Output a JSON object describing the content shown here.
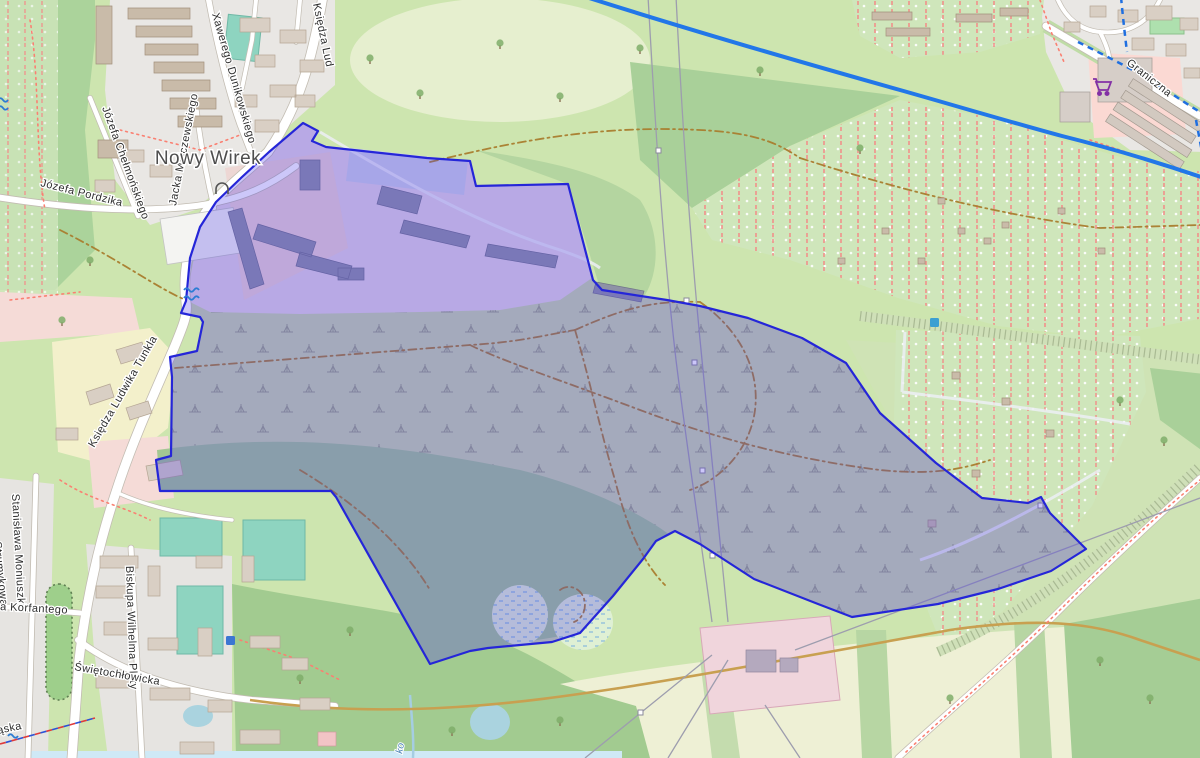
{
  "map": {
    "labels": {
      "place": [
        {
          "text": "Nowy Wirek"
        }
      ],
      "streets": [
        {
          "text": "Xawerego Dunikowskiego"
        },
        {
          "text": "Jacka Malczewskiego"
        },
        {
          "text": "Józefa Chełmońskiego"
        },
        {
          "text": "Księdza Lud"
        },
        {
          "text": "Józefa Pordzika"
        },
        {
          "text": "Księdza Ludwika Tunkla"
        },
        {
          "text": "Stanisława Moniuszki"
        },
        {
          "text": "Strumykowa"
        },
        {
          "text": "a Korfantego"
        },
        {
          "text": "Biskupa Wilhelma Pluty"
        },
        {
          "text": "Świętochłowicka"
        },
        {
          "text": "ąska"
        },
        {
          "text": "Graniczna"
        }
      ],
      "water": [
        {
          "text": "ko"
        }
      ]
    },
    "icons": [
      {
        "name": "supermarket-cart-icon",
        "meaning": "supermarket POI"
      },
      {
        "name": "water-wave-icon",
        "meaning": "weir / water flow"
      },
      {
        "name": "bridge-arch-icon",
        "meaning": "arch / tunnel portal"
      },
      {
        "name": "power-pylon-marker",
        "meaning": "power pylon"
      },
      {
        "name": "poi-marker",
        "meaning": "small blue POI square"
      }
    ],
    "colors": {
      "selection_fill": "#4736e8",
      "selection_border": "#2526d8",
      "water": "#aad3df",
      "cycle_route": "#1f6fe0",
      "major_route": "#2277e8",
      "track": "#a97d2e",
      "footpath": "#fa8072",
      "pitch": "#8ed4c0",
      "industrial": "#e3d6e4",
      "retail": "#fbd9d3",
      "residential": "#e9e7e4",
      "forest": "#a5cd95",
      "scrub": "#c8d7ab",
      "farmland": "#eef0d5",
      "allotments": "#cfe6bb",
      "grass": "#cde5af",
      "substation": "#f0d5dc",
      "supermarket_icon": "#8330a5"
    }
  }
}
